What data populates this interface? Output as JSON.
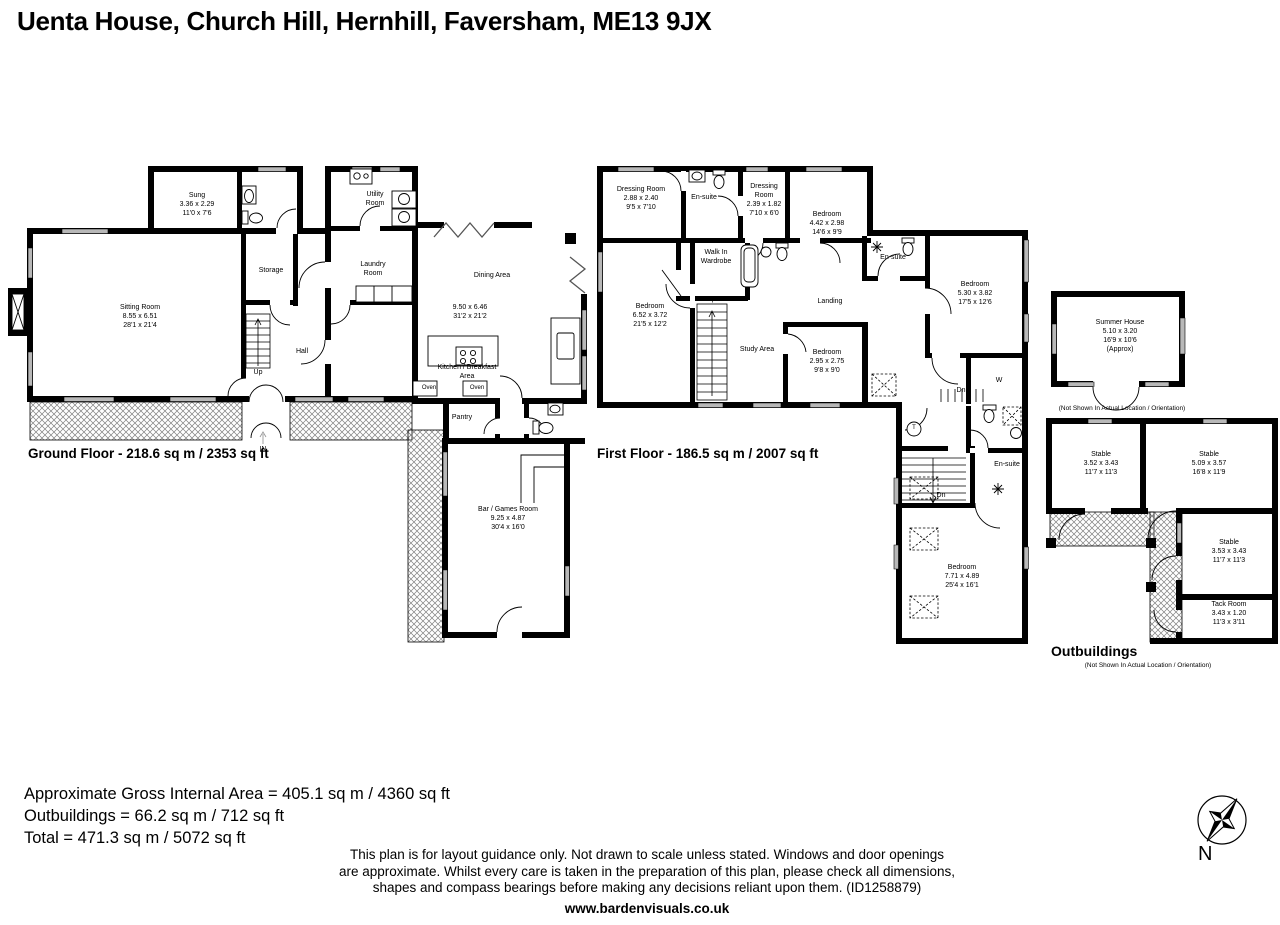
{
  "page": {
    "title": "Uenta House, Church Hill, Hernhill, Faversham, ME13 9JX",
    "compass_label": "N",
    "website": "www.bardenvisuals.co.uk"
  },
  "ground_floor": {
    "title": "Ground Floor - 218.6 sq m / 2353 sq ft",
    "entrance_label": "IN",
    "stairs_label": "Up",
    "rooms": {
      "snug": {
        "name": "Sung",
        "metric": "3.36 x 2.29",
        "imperial": "11'0 x 7'6"
      },
      "sitting_room": {
        "name": "Sitting Room",
        "metric": "8.55 x 6.51",
        "imperial": "28'1 x 21'4"
      },
      "storage": {
        "name": "Storage"
      },
      "hall": {
        "name": "Hall"
      },
      "utility_room": {
        "name": "Utility Room"
      },
      "laundry_room": {
        "name": "Laundry Room"
      },
      "dining_area": {
        "name": "Dining Area",
        "metric": "9.50 x 6.46",
        "imperial": "31'2 x 21'2"
      },
      "kitchen": {
        "name": "Kitchen / Breakfast Area"
      },
      "pantry": {
        "name": "Pantry"
      },
      "oven": {
        "name": "Oven"
      },
      "bar_games_room": {
        "name": "Bar / Games Room",
        "metric": "9.25 x 4.87",
        "imperial": "30'4 x 16'0"
      }
    }
  },
  "first_floor": {
    "title": "First Floor - 186.5 sq m / 2007 sq ft",
    "stairs_up_label": "Up",
    "stairs_down_label": "Dn",
    "wardrobe_label": "W",
    "tank_label": "T",
    "rooms": {
      "dressing_room_1": {
        "name": "Dressing Room",
        "metric": "2.88 x 2.40",
        "imperial": "9'5 x 7'10"
      },
      "en_suite_1": {
        "name": "En-suite"
      },
      "dressing_room_2": {
        "name": "Dressing Room",
        "metric": "2.39 x 1.82",
        "imperial": "7'10 x 6'0"
      },
      "bedroom_1": {
        "name": "Bedroom",
        "metric": "4.42 x 2.98",
        "imperial": "14'6 x 9'9"
      },
      "walk_in_wardrobe": {
        "name": "Walk In Wardrobe"
      },
      "bedroom_2": {
        "name": "Bedroom",
        "metric": "6.52 x 3.72",
        "imperial": "21'5 x 12'2"
      },
      "study_area": {
        "name": "Study Area"
      },
      "landing": {
        "name": "Landing"
      },
      "bedroom_3": {
        "name": "Bedroom",
        "metric": "2.95 x 2.75",
        "imperial": "9'8 x 9'0"
      },
      "en_suite_2": {
        "name": "En-suite"
      },
      "bedroom_4": {
        "name": "Bedroom",
        "metric": "5.30 x 3.82",
        "imperial": "17'5 x 12'6"
      },
      "en_suite_3": {
        "name": "En-suite"
      },
      "bedroom_5": {
        "name": "Bedroom",
        "metric": "7.71 x 4.89",
        "imperial": "25'4 x 16'1"
      }
    }
  },
  "outbuildings": {
    "title": "Outbuildings",
    "note": "(Not Shown In Actual Location / Orientation)",
    "summer_house_note": "(Not Shown In Actual Location / Orientation)",
    "rooms": {
      "summer_house": {
        "name": "Summer House",
        "metric": "5.10 x 3.20",
        "imperial": "16'9 x 10'6",
        "approx": "(Approx)"
      },
      "stable_1": {
        "name": "Stable",
        "metric": "3.52 x 3.43",
        "imperial": "11'7 x 11'3"
      },
      "stable_2": {
        "name": "Stable",
        "metric": "5.09 x 3.57",
        "imperial": "16'8 x 11'9"
      },
      "stable_3": {
        "name": "Stable",
        "metric": "3.53 x 3.43",
        "imperial": "11'7 x 11'3"
      },
      "tack_room": {
        "name": "Tack Room",
        "metric": "3.43 x 1.20",
        "imperial": "11'3 x 3'11"
      }
    }
  },
  "footer": {
    "area_lines": [
      "Approximate Gross Internal Area = 405.1 sq m / 4360 sq ft",
      "Outbuildings = 66.2 sq m / 712 sq ft",
      "Total = 471.3 sq m / 5072 sq ft"
    ],
    "disclaimer_lines": [
      "This plan is for layout guidance only. Not drawn to scale unless stated. Windows and door openings",
      "are approximate. Whilst every care is taken in the preparation of this plan, please check all dimensions,",
      "shapes and compass bearings before making any decisions reliant upon them. (ID1258879)"
    ]
  },
  "colors": {
    "wall": "#000000",
    "window_fill": "#b8b8b8",
    "hatch_line": "#808080"
  }
}
